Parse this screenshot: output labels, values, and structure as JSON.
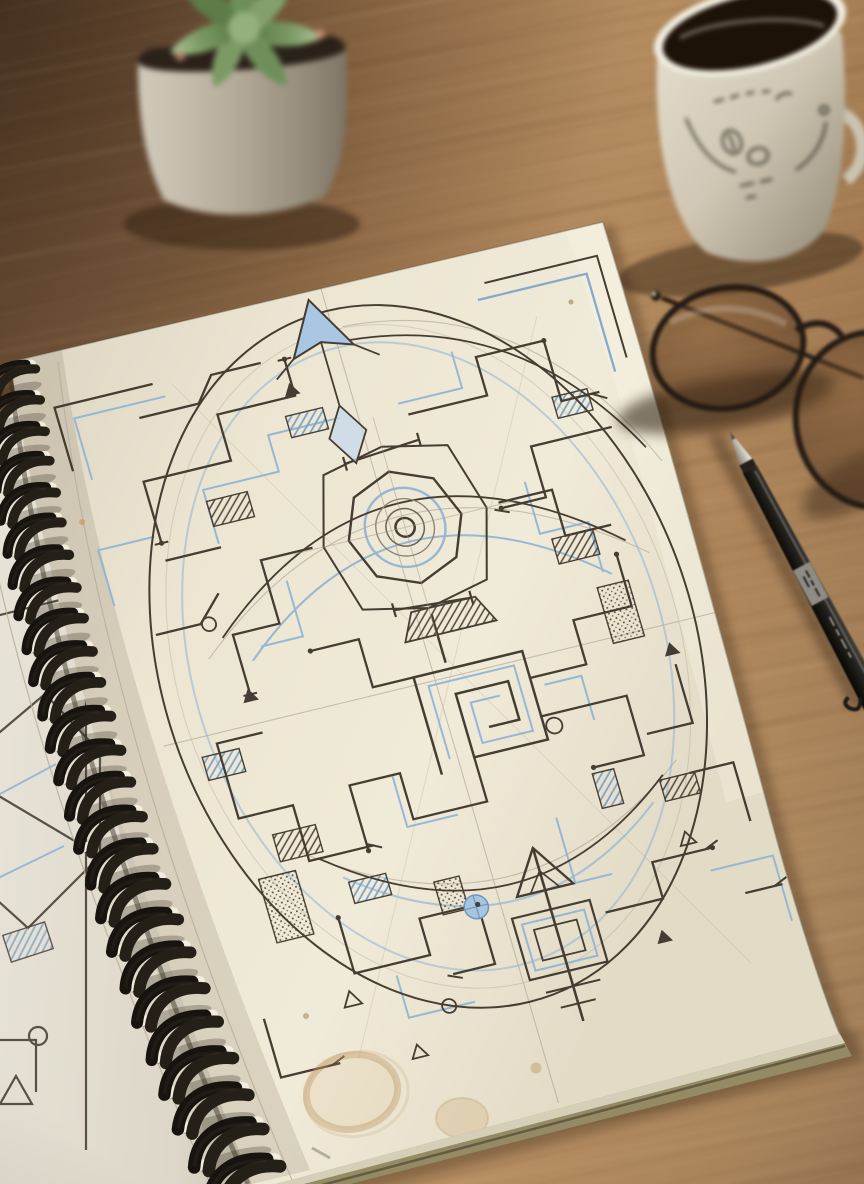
{
  "scene": {
    "title": "Spiral sketchbook with geometric maze drawing on a wooden desk",
    "palette": {
      "wood": "#a87f55",
      "wood_highlight": "#c9a27a",
      "paper": "#ece6d3",
      "paper_shadow": "#d8d2c0",
      "ink": "#463d32",
      "blue_pencil": "#8fb2d3",
      "grey_pencil": "#a59c8b",
      "binding": "#17140f",
      "coffee": "#201310",
      "stain": "#c8a465"
    },
    "objects": [
      {
        "id": "desk",
        "label": "Warm oak desk surface with diagonal grain",
        "color": "#a87f55"
      },
      {
        "id": "plant",
        "label": "Small succulent in a grey-white ceramic pot, out of focus",
        "colors": [
          "#7d9a66",
          "#c2bbac",
          "#c98f74"
        ]
      },
      {
        "id": "mug",
        "label": "Cream ceramic mug of black coffee with small illegible sketch doodles",
        "colors": [
          "#ded8c8",
          "#201310"
        ]
      },
      {
        "id": "glasses",
        "label": "Black thin round-frame eyeglasses lying folded on the desk",
        "color": "#241b14"
      },
      {
        "id": "pen",
        "label": "Black fineliner drawing pen with silver metal tip and illegible barrel print",
        "colors": [
          "#1d1b18",
          "#8e8b85"
        ]
      },
      {
        "id": "notebook",
        "label": "Wire-o spiral-bound sketchbook, cream paper, black coils",
        "colors": {
          "paper": "#ece6d3",
          "coils": "#17140f"
        }
      },
      {
        "id": "left-page",
        "label": "Edge of previous page with partial geometric sketches",
        "color": "#e6e1d4"
      },
      {
        "id": "maze-drawing",
        "label": "Hand-drawn rectilinear maze mandala inside an oval: black ink corridors, light-blue pencil accents, hatched and stippled cells, concentric-circle target, greek-key spiral, kite arrow at top, cross arrow at bottom",
        "colors": {
          "ink": "#463d32",
          "blue": "#8fb2d3",
          "pencil": "#a59c8b"
        }
      },
      {
        "id": "coffee-stain",
        "label": "Coffee ring and drip stains near bottom of the page",
        "color": "#c8a465"
      }
    ]
  }
}
